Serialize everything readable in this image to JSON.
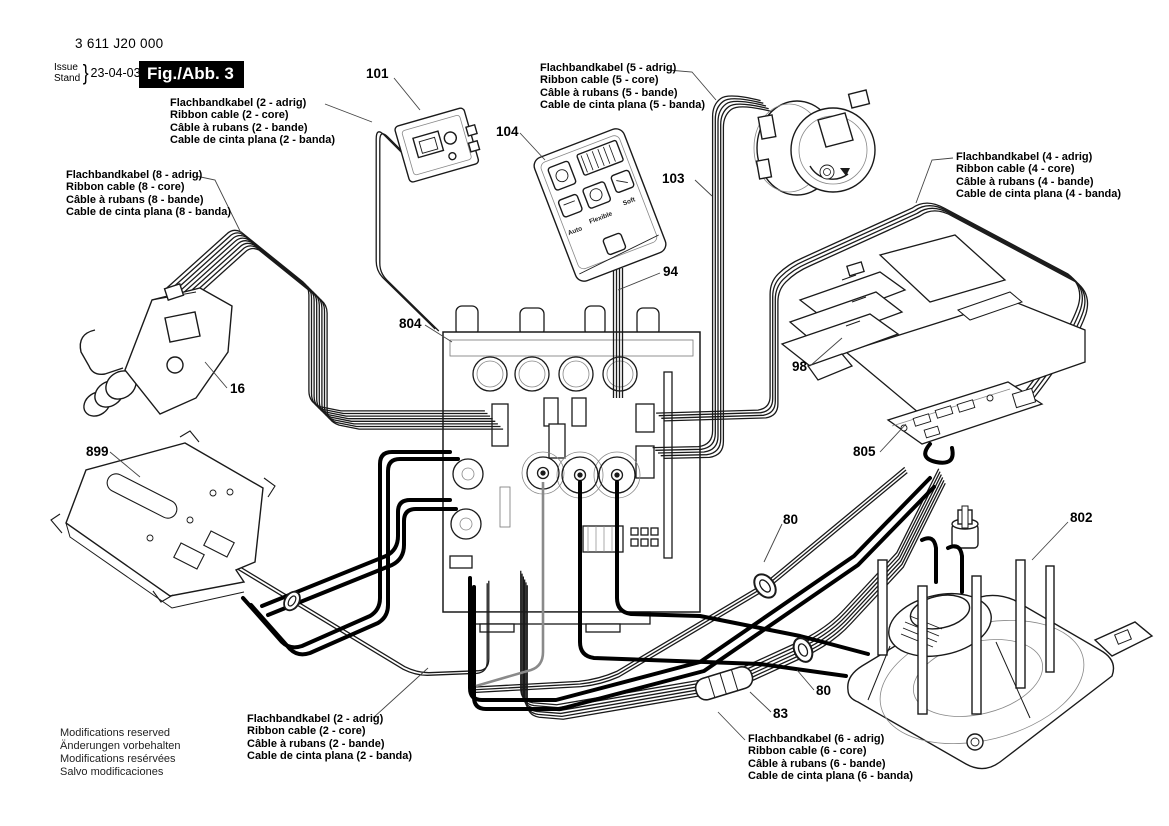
{
  "header": {
    "part_number": "3 611 J20 000",
    "issue_label": "Issue",
    "stand_label": "Stand",
    "brace": "}",
    "date": "23-04-03",
    "figure_label": "Fig./Abb. 3"
  },
  "cable_labels": {
    "c2_top": {
      "lines": [
        "Flachbandkabel (2 - adrig)",
        "Ribbon cable (2 - core)",
        "Câble à rubans (2 - bande)",
        "Cable de cinta plana (2 - banda)"
      ]
    },
    "c5": {
      "lines": [
        "Flachbandkabel (5 - adrig)",
        "Ribbon cable (5 - core)",
        "Câble à rubans (5 - bande)",
        "Cable de cinta plana (5 - banda)"
      ]
    },
    "c4": {
      "lines": [
        "Flachbandkabel (4 - adrig)",
        "Ribbon cable (4 - core)",
        "Câble à rubans (4 - bande)",
        "Cable de cinta plana (4 - banda)"
      ]
    },
    "c8": {
      "lines": [
        "Flachbandkabel (8 - adrig)",
        "Ribbon cable (8 - core)",
        "Câble à rubans (8 - bande)",
        "Cable de cinta plana (8 - banda)"
      ]
    },
    "c2_bottom": {
      "lines": [
        "Flachbandkabel (2 - adrig)",
        "Ribbon cable (2 - core)",
        "Câble à rubans (2 - bande)",
        "Cable de cinta plana (2 - banda)"
      ]
    },
    "c6": {
      "lines": [
        "Flachbandkabel (6 - adrig)",
        "Ribbon cable (6 - core)",
        "Câble à rubans (6 - bande)",
        "Cable de cinta plana (6 - banda)"
      ]
    }
  },
  "part_numbers": {
    "p101": "101",
    "p104": "104",
    "p103": "103",
    "p94": "94",
    "p804": "804",
    "p16": "16",
    "p899": "899",
    "p98": "98",
    "p805": "805",
    "p80a": "80",
    "p802": "802",
    "p80b": "80",
    "p83": "83"
  },
  "remote_buttons": [
    "Auto",
    "Flexible",
    "Soft"
  ],
  "footer": {
    "lines": [
      "Modifications reserved",
      "Änderungen vorbehalten",
      "Modifications resérvées",
      "Salvo modificaciones"
    ]
  },
  "colors": {
    "line": "#1a1a1a",
    "background": "#ffffff",
    "figure_box": "#000000"
  }
}
